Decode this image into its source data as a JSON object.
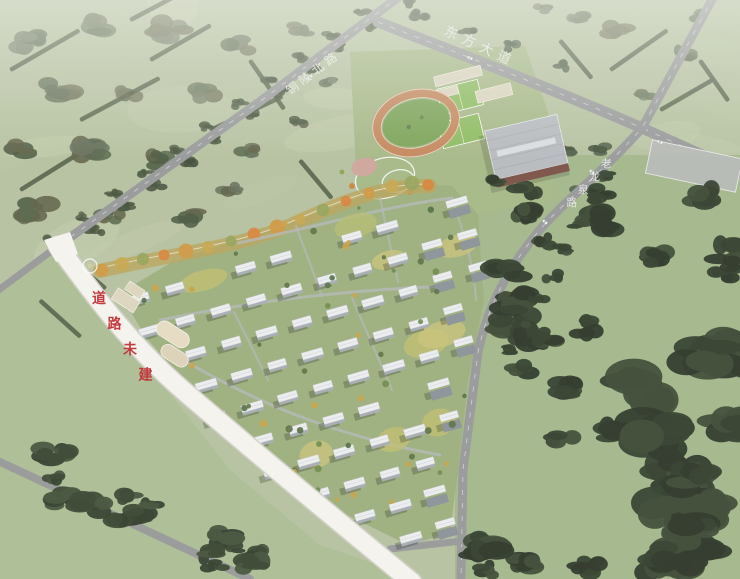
{
  "labels": {
    "road_northwest": "铜陵北路",
    "avenue_north": "东方大道",
    "road_east": "老龙泉路",
    "unbuilt_road_note": "道路未建"
  },
  "palette": {
    "field": "#b6c2a0",
    "field_light": "#c6d0ae",
    "meadow": "#adbf94",
    "forest_dark": "#313d2b",
    "forest_mid": "#4c5a41",
    "road_gray": "#97999a",
    "road_white": "#f6f5f0",
    "track_orange": "#c5875b",
    "pitch_green": "#7aa355",
    "court_green": "#8cbc5e",
    "roof_gray": "#b7bbbf",
    "facade_brown": "#7b5046",
    "building_roof": "#edeff0",
    "building_face": "#9aa1a8",
    "park_autumn": "#d0983f",
    "lot_gray": "#b6bab4",
    "beige": "#ddd6bf",
    "label_red": "#c1272d",
    "label_white": "#f2f4f1"
  }
}
